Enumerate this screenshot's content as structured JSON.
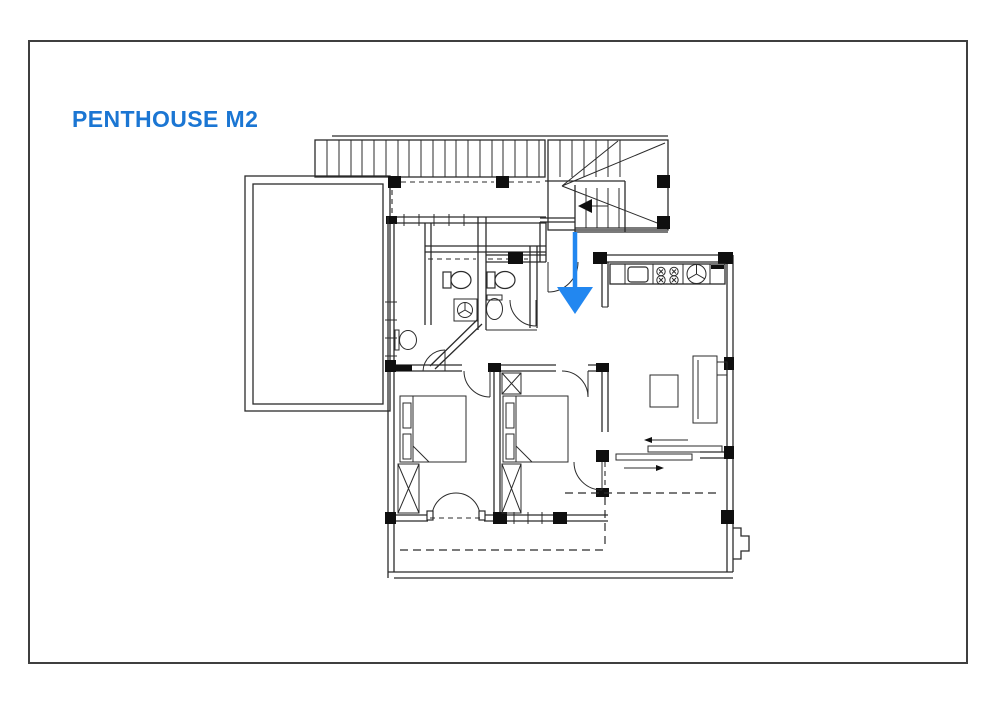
{
  "sheet": {
    "title": "PENTHOUSE M2",
    "colors": {
      "title_text": "#1B76D3",
      "annotation_arrow": "#2287F0",
      "drawing_lines": "#2B2B2B",
      "sheet_border": "#3F3F3F",
      "background": "#FFFFFF"
    },
    "drawing": {
      "kind": "architectural floor plan",
      "annotation": "blue down-arrow marking the unit entrance",
      "symbols": [
        "staircase-with-winder",
        "side-terrace",
        "corridor-window",
        "kitchen-counter-sink-stove-appliance",
        "bathroom-toilet",
        "bathroom-shower",
        "bathroom-basin",
        "double-bed",
        "wardrobe-x-box",
        "door-swing-arc",
        "sliding-door-arrows",
        "french-balcony-doors",
        "roof-overhang-dashed-lines",
        "structural-columns"
      ]
    }
  }
}
